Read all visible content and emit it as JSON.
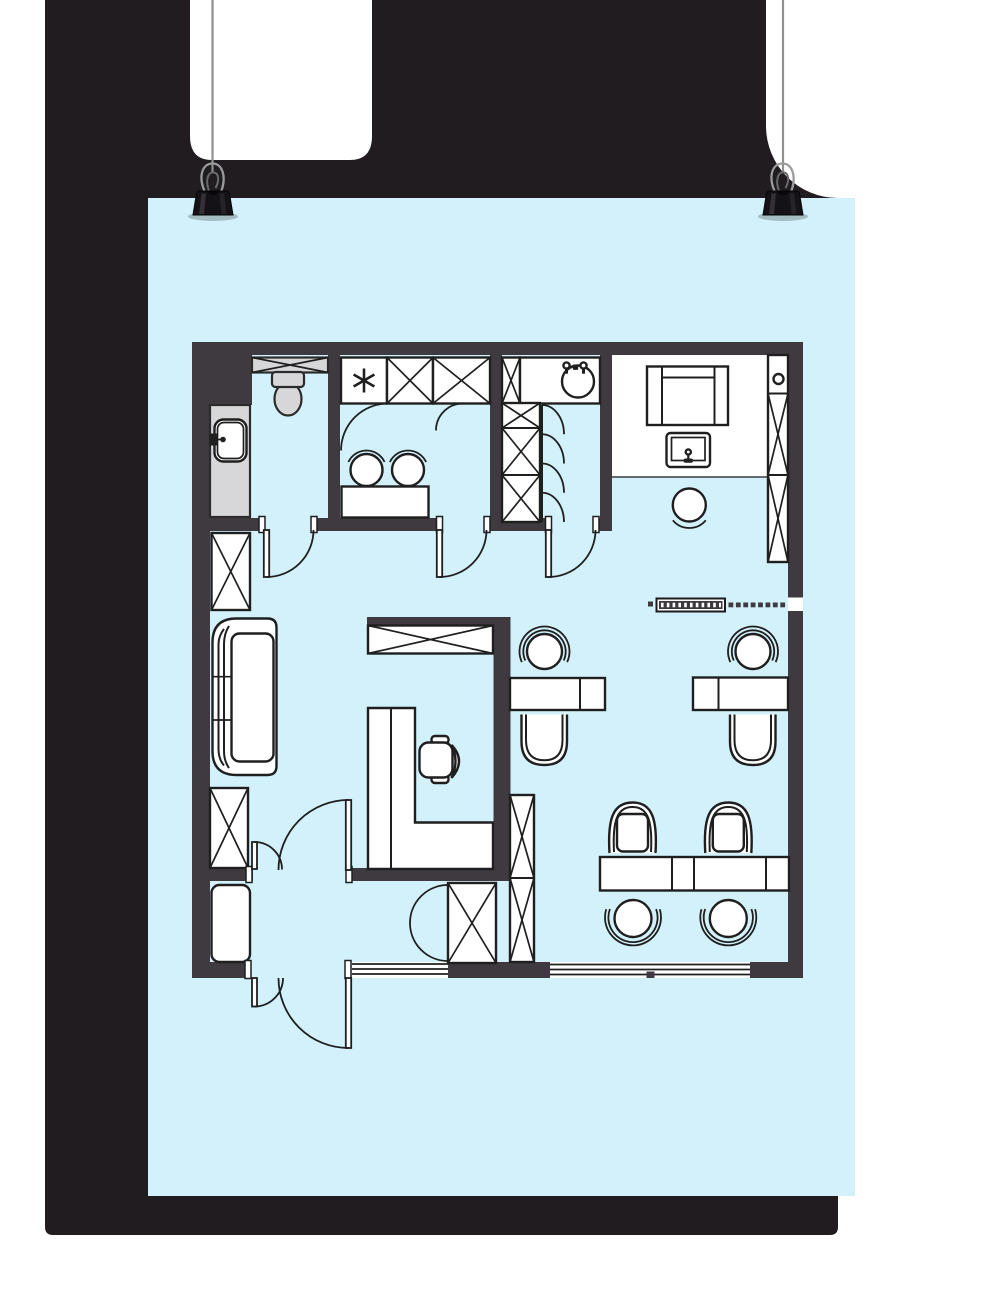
{
  "canvas": {
    "width": 1000,
    "height": 1300
  },
  "colors": {
    "canvas": "#ffffff",
    "backdrop": "#201c20",
    "paper": "#d3f1fa",
    "wall": "#3e3a40",
    "line": "#1f1f1f",
    "gray": "#d7d6d9",
    "string": "#8f8f8f",
    "white": "#ffffff"
  },
  "scene": {
    "description": "Cyan paper poster with an architectural office floor plan, hanging from two strings with black binder clips against a dark panel",
    "poster": {
      "media": "light-cyan paper sheet",
      "content": "top-down office floor plan drawing",
      "hanging": [
        "string-left",
        "string-right",
        "binder-clip-left",
        "binder-clip-right"
      ]
    },
    "floor_plan": {
      "rooms": [
        "wc",
        "bathroom",
        "storage-closet",
        "lounge",
        "open-office",
        "entry-vestibule",
        "hallway"
      ],
      "fixtures": [
        "toilet",
        "ventilation-shaft",
        "recessed-sink-cabinet",
        "star-fixture",
        "wardrobe-x-boxes",
        "double-basin-vanity",
        "round-utility-sink",
        "folding-closet-doors",
        "lounge-sofa",
        "tv-table",
        "lounge-round-chair",
        "display-cabinet-with-circle",
        "glass-partition-with-radiator",
        "workstation-desk-1",
        "workstation-desk-2",
        "task-chair-1",
        "task-chair-2",
        "guest-cup-chair-1",
        "guest-cup-chair-2",
        "l-shaped-desk",
        "office-swivel-chair",
        "meeting-table",
        "meeting-arm-chairs",
        "meeting-round-chairs",
        "tall-x-cabinets",
        "shoe-bench",
        "left-couch",
        "unequal-double-entry-doors",
        "interior-swing-doors",
        "double-action-door",
        "windows"
      ]
    }
  }
}
